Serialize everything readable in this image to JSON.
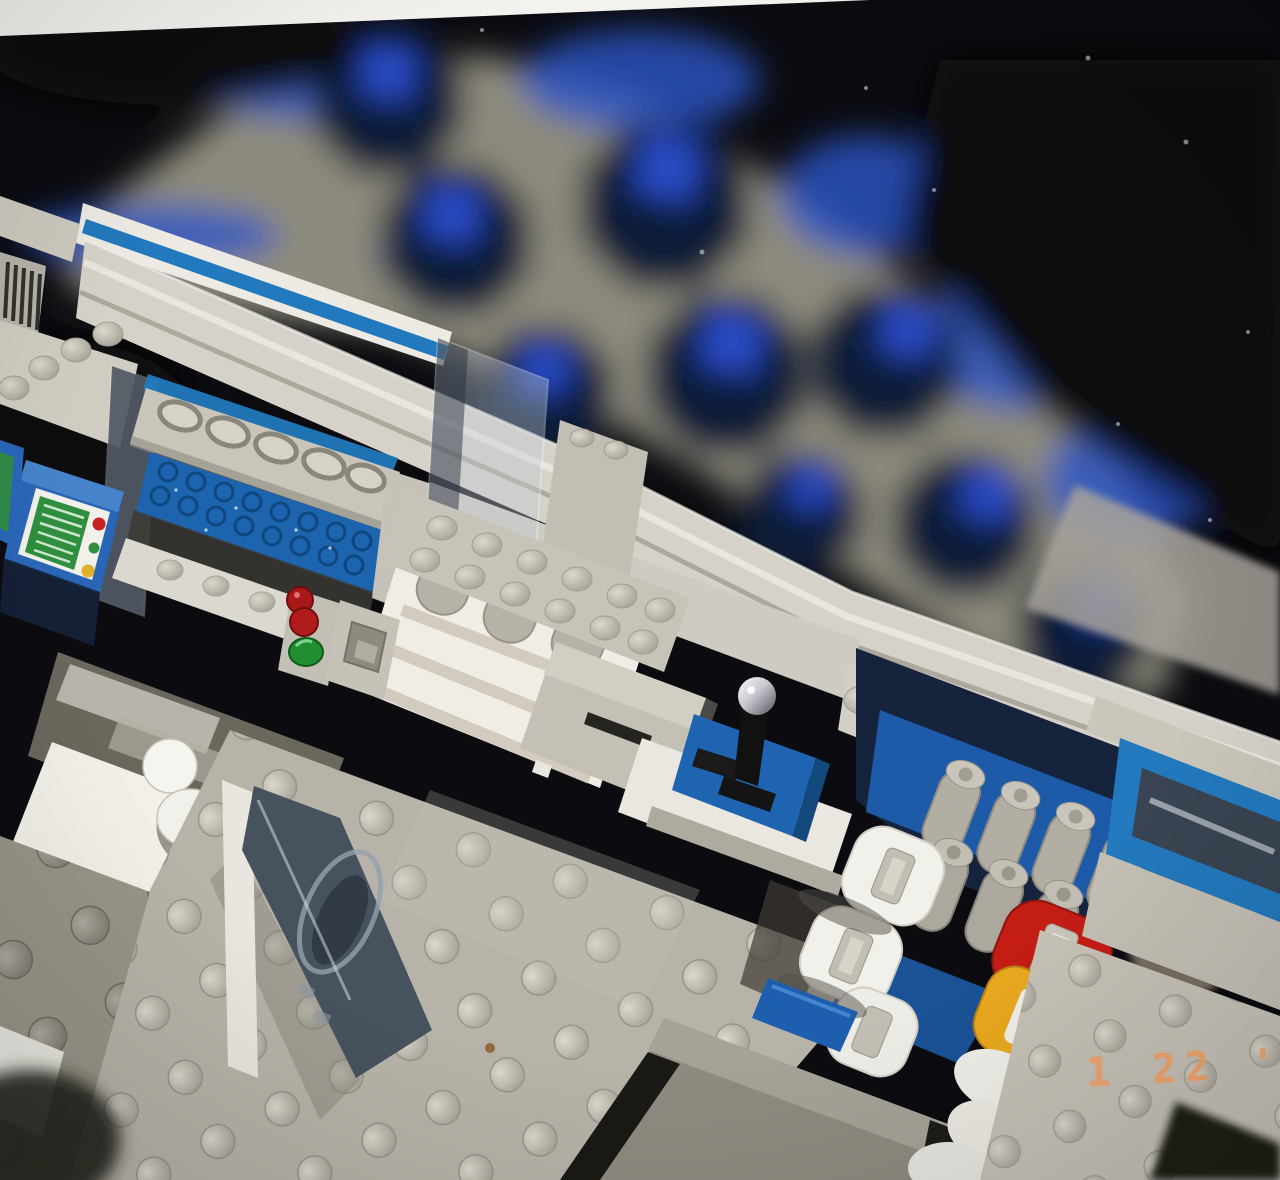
{
  "photo": {
    "kind": "scanned film photograph",
    "subject": "Overhead view of a LEGO classic-space base interior model against a black backdrop",
    "date_stamp": {
      "text": "1 22 '0"
    }
  },
  "palette": {
    "space_black": "#0b0b10",
    "photo_border": "#f3f2ee",
    "deck_blur_gray": "#8e8b7d",
    "pod_navy": "#0d1a38",
    "pod_blue": "#2a4ecb",
    "hull_light": "#d6d2c9",
    "hull_white": "#eceae3",
    "floor_gray": "#b7b3a9",
    "stripe_blue": "#2279bd",
    "lego_blue": "#1d64ae",
    "console_blue": "#2a66b8",
    "screen_green": "#2f8f3e",
    "button_red": "#c42222",
    "button_yellow": "#e0b02a",
    "fairing_red": "#c41d14",
    "fairing_yellow": "#e9a81e",
    "date_orange": "#f2a368"
  },
  "scene": {
    "background": [
      "deep black space backdrop with dust specks",
      "out-of-focus lower deck band in gray",
      "dark navy octagonal pods with bright blue square cores"
    ],
    "elements": [
      {
        "id": "computer-console",
        "label": "blue slope-brick computer console with green screen and red/green/yellow buttons"
      },
      {
        "id": "airlock-door",
        "label": "blue textured sliding door beneath arched grille lintel with blue wall stripes"
      },
      {
        "id": "signal-lights",
        "label": "trans-red and trans-green signal lights on gray bracket"
      },
      {
        "id": "supply-shelf",
        "label": "white shelf rack holding gray canisters under a 2x6 gray plate"
      },
      {
        "id": "dispenser",
        "label": "gray dispenser box with dark slot"
      },
      {
        "id": "scanner-table",
        "label": "black scope instrument with chrome head on blue pad over white table"
      },
      {
        "id": "white-droid",
        "label": "small white droid in bright alcove"
      },
      {
        "id": "porthole-panel",
        "label": "smoked porthole window panel seen edge-on"
      },
      {
        "id": "engine-rack",
        "label": "rack of gray thruster cylinders against blue wall"
      },
      {
        "id": "fairings",
        "label": "white, red and yellow pod fairings with handle slots"
      },
      {
        "id": "canopy-window",
        "label": "blue-framed smoked canopy window strip"
      },
      {
        "id": "stud-floor",
        "label": "light gray LEGO stud plating across the floors"
      }
    ]
  }
}
